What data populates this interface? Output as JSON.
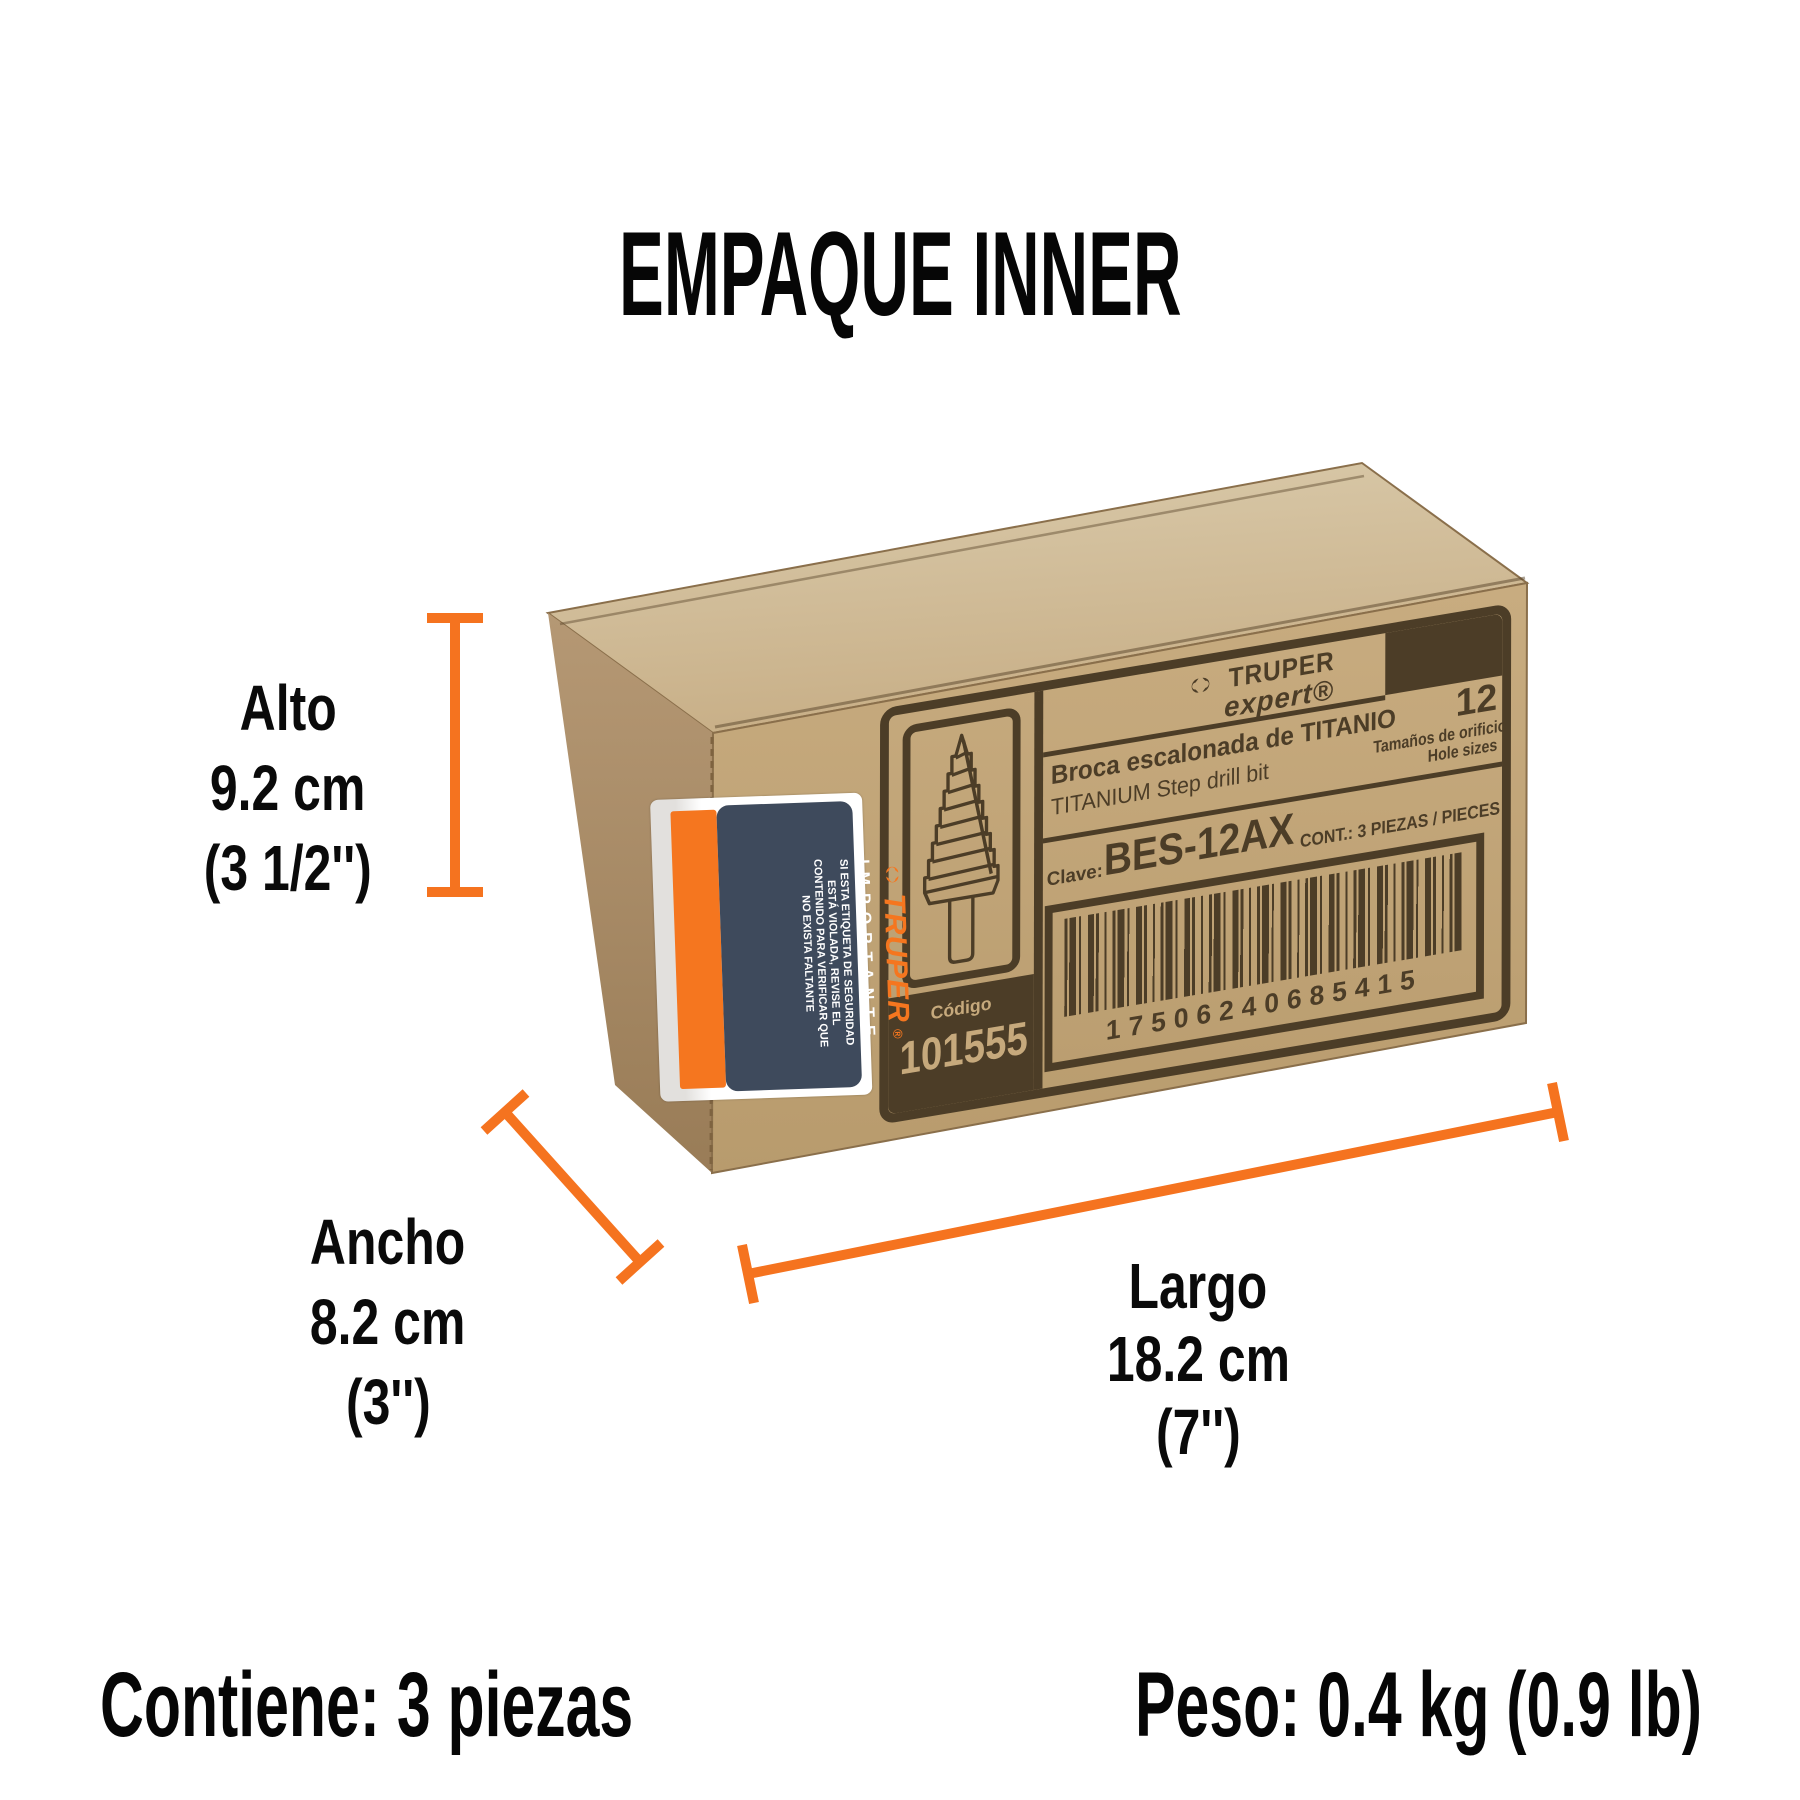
{
  "title": "EMPAQUE INNER",
  "dimensions": {
    "alto": {
      "label": "Alto",
      "value": "9.2 cm",
      "inches": "(3 1/2'')"
    },
    "ancho": {
      "label": "Ancho",
      "value": "8.2 cm",
      "inches": "(3'')"
    },
    "largo": {
      "label": "Largo",
      "value": "18.2 cm",
      "inches": "(7'')"
    }
  },
  "footer": {
    "contains_label": "Contiene:",
    "contains_value": "3 piezas",
    "weight_label": "Peso:",
    "weight_value": "0.4 kg (0.9 lb)"
  },
  "box_label": {
    "brand": "TRUPER",
    "brand_sub": "expert®",
    "product_es": "Broca escalonada de TITANIO",
    "product_en": "TITANIUM Step drill bit",
    "sizes_count": "12",
    "sizes_es": "Tamaños de orificio",
    "sizes_en": "Hole sizes",
    "key_label": "Clave:",
    "key_value": "BES-12AX",
    "content_line": "CONT.:  3 PIEZAS / PIECES",
    "barcode_digits": "17506240685415",
    "code_label": "Código",
    "code_value": "101555"
  },
  "sticker": {
    "brand": "TRUPER",
    "reg_mark": "®",
    "heading": "IMPORTANTE",
    "lines": [
      "SI ESTA ETIQUETA DE SEGURIDAD",
      "ESTÁ VIOLADA, REVISE EL",
      "CONTENIDO PARA VERIFICAR QUE",
      "NO EXISTA FALTANTE"
    ]
  },
  "colors": {
    "accent_orange": "#F5731F",
    "print_brown": "#4C3D27",
    "sticker_navy": "#3E4A5C",
    "cardboard_front": "#C3A77B",
    "cardboard_top": "#D2BD9B",
    "cardboard_side": "#AB8E66"
  },
  "icons": {
    "brand_knot": "truper-knot-icon",
    "drill": "step-drill-icon"
  }
}
